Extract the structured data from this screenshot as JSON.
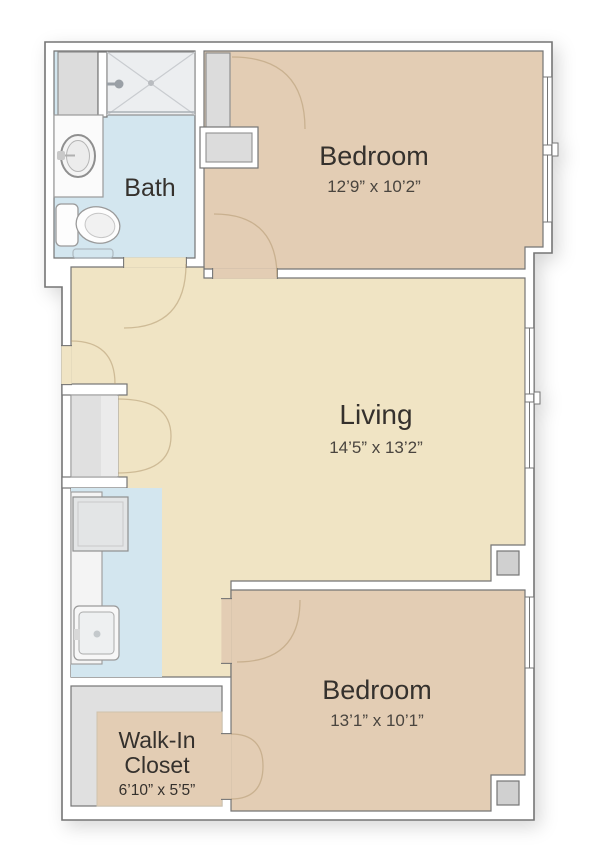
{
  "floor_plan": {
    "rooms": {
      "bath": {
        "label": "Bath"
      },
      "bedroom_top": {
        "label": "Bedroom",
        "dimensions": "12’9” x 10’2”"
      },
      "living": {
        "label": "Living",
        "dimensions": "14’5” x 13’2”"
      },
      "bedroom_bottom": {
        "label": "Bedroom",
        "dimensions": "13’1” x 10’1”"
      },
      "walk_in_closet": {
        "label_line1": "Walk-In",
        "label_line2": "Closet",
        "dimensions": "6’10” x 5’5”"
      }
    },
    "fixtures": [
      "shower",
      "linen-closet",
      "vanity-sink",
      "toilet",
      "bath-mat",
      "kitchen-counter",
      "range",
      "kitchen-sink",
      "bedroom-closet",
      "closet-niche",
      "hall-closet",
      "column"
    ],
    "colors": {
      "wall_stroke": "#757575",
      "fixture_stroke": "#8f8f8f",
      "bath_floor": "#d3e6ef",
      "kitchen_floor": "#d3e6ef",
      "bedroom_floor": "#e3cdb4",
      "living_floor": "#f0e4c4",
      "closet_gray": "#dcdcdc",
      "shower_gray": "#eceef0",
      "walkin_gray": "#e0e0e0",
      "column_gray": "#d0d0d0",
      "door_arc": "#b49a72"
    }
  }
}
